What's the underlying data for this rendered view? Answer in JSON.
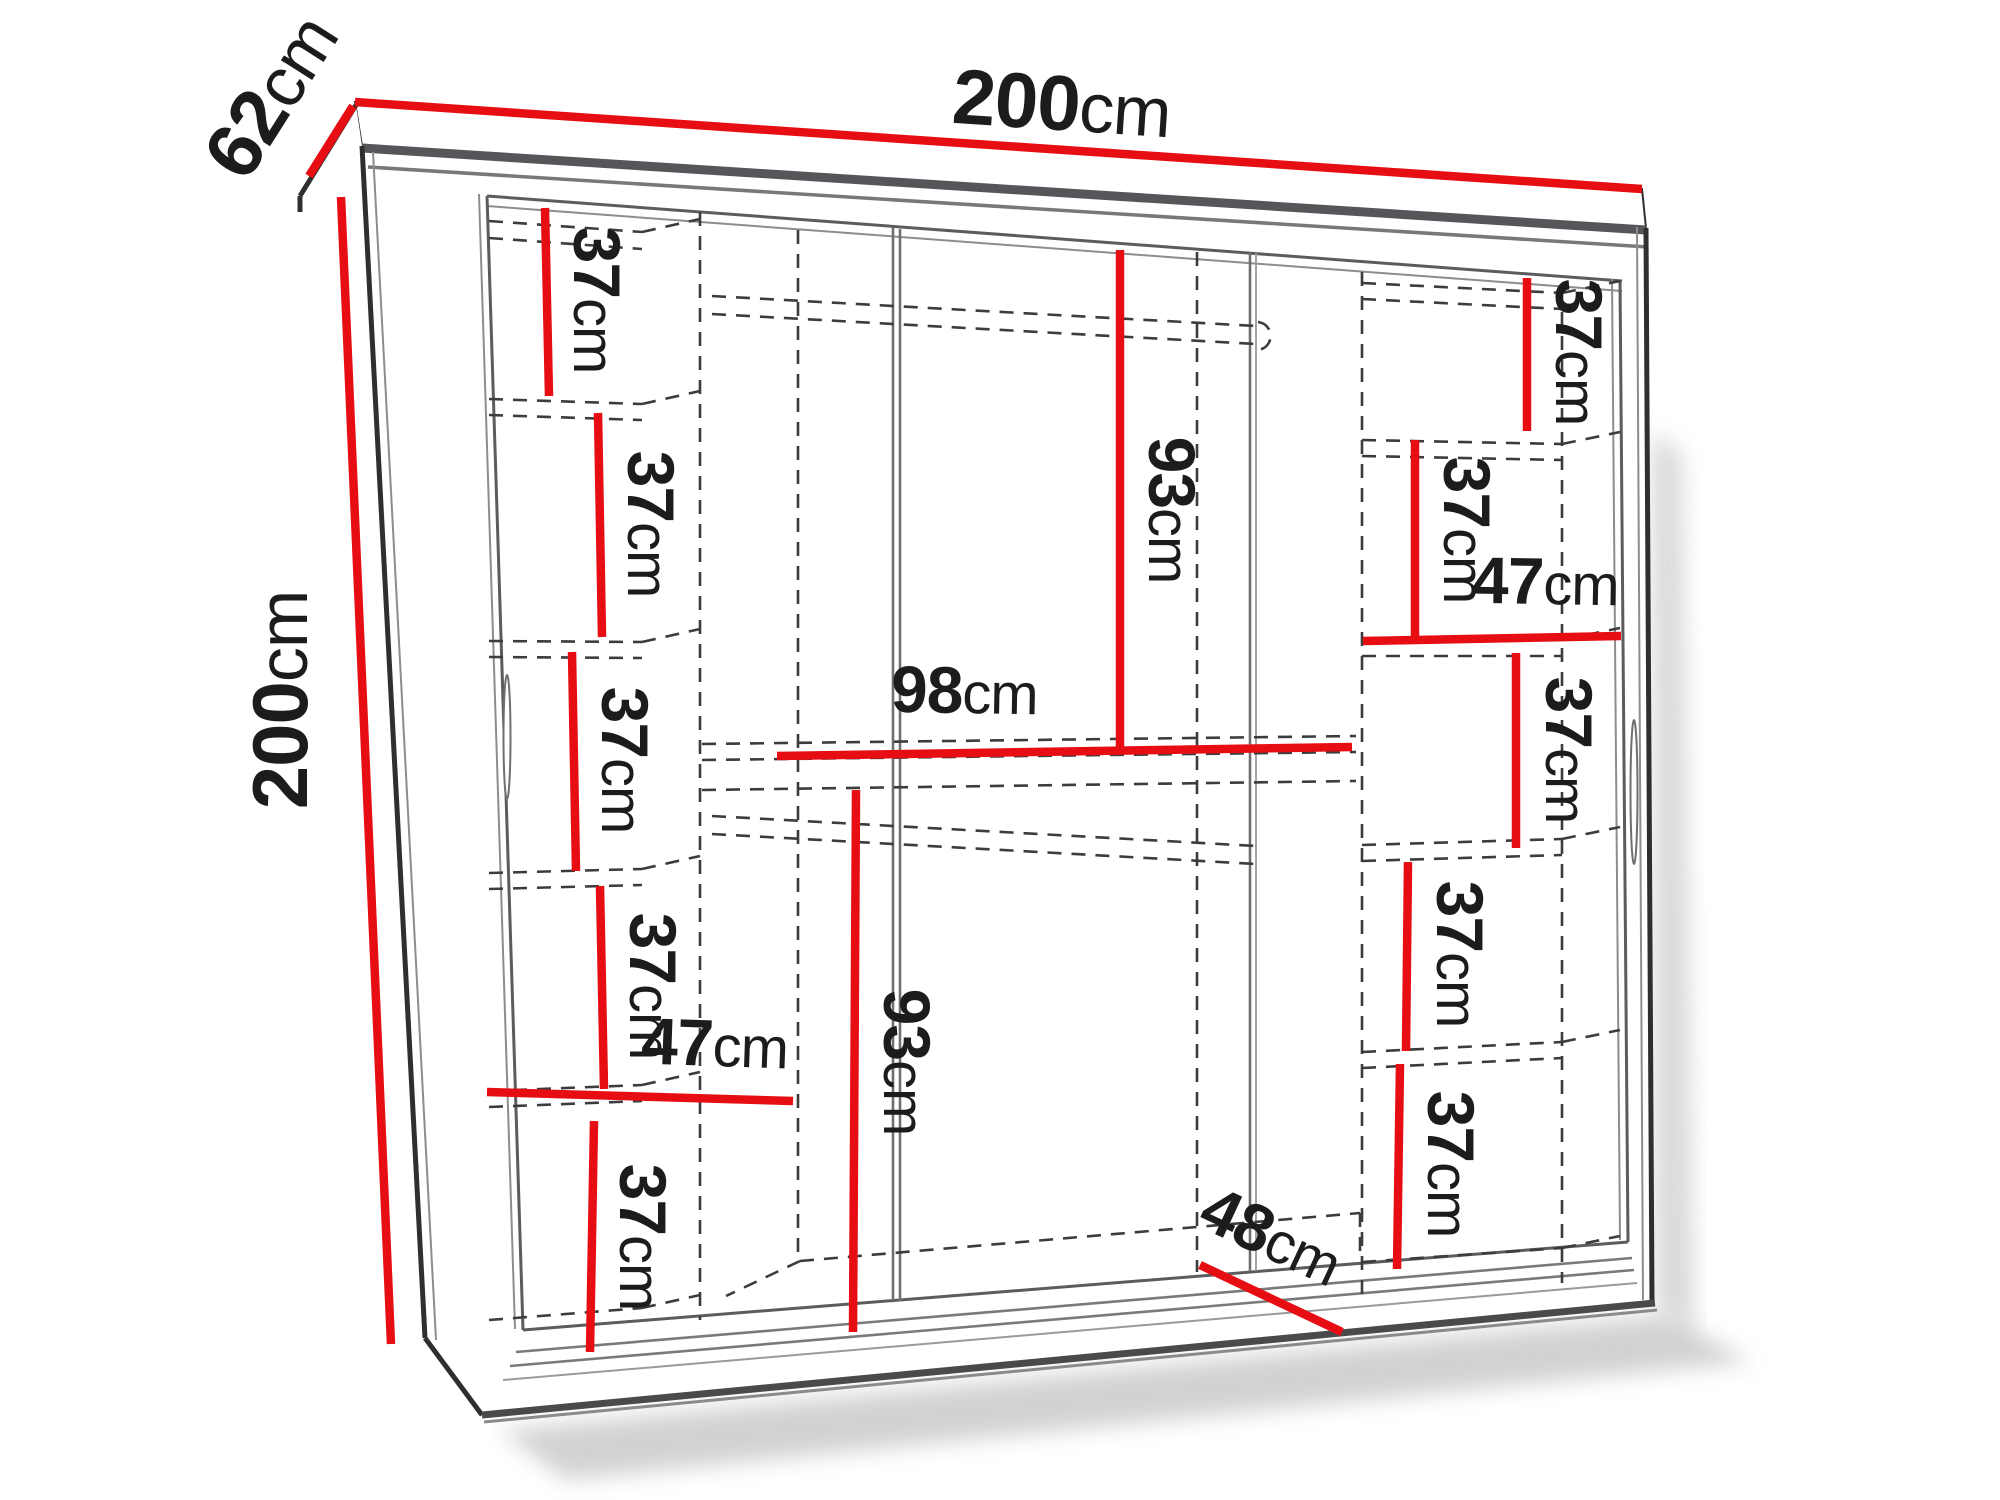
{
  "colors": {
    "dimension_red": "#e60e13",
    "outline_dark": "#2f2f30",
    "line_gray": "#6f6f71",
    "dashed_gray": "#3c3c3e",
    "text": "#1c1c1e"
  },
  "wardrobe": {
    "overall": {
      "width": {
        "n": "200",
        "u": "cm"
      },
      "depth": {
        "n": "62",
        "u": "cm"
      },
      "height": {
        "n": "200",
        "u": "cm"
      }
    },
    "left_column": {
      "width": {
        "n": "47",
        "u": "cm"
      },
      "shelf_heights": [
        {
          "n": "37",
          "u": "cm"
        },
        {
          "n": "37",
          "u": "cm"
        },
        {
          "n": "37",
          "u": "cm"
        },
        {
          "n": "37",
          "u": "cm"
        },
        {
          "n": "37",
          "u": "cm"
        }
      ]
    },
    "middle_section": {
      "upper_hanging_height": {
        "n": "93",
        "u": "cm"
      },
      "width": {
        "n": "98",
        "u": "cm"
      },
      "lower_hanging_height": {
        "n": "93",
        "u": "cm"
      },
      "floor_depth": {
        "n": "48",
        "u": "cm"
      }
    },
    "right_column": {
      "width": {
        "n": "47",
        "u": "cm"
      },
      "shelf_heights": [
        {
          "n": "37",
          "u": "cm"
        },
        {
          "n": "37",
          "u": "cm"
        },
        {
          "n": "37",
          "u": "cm"
        },
        {
          "n": "37",
          "u": "cm"
        },
        {
          "n": "37",
          "u": "cm"
        }
      ]
    }
  }
}
